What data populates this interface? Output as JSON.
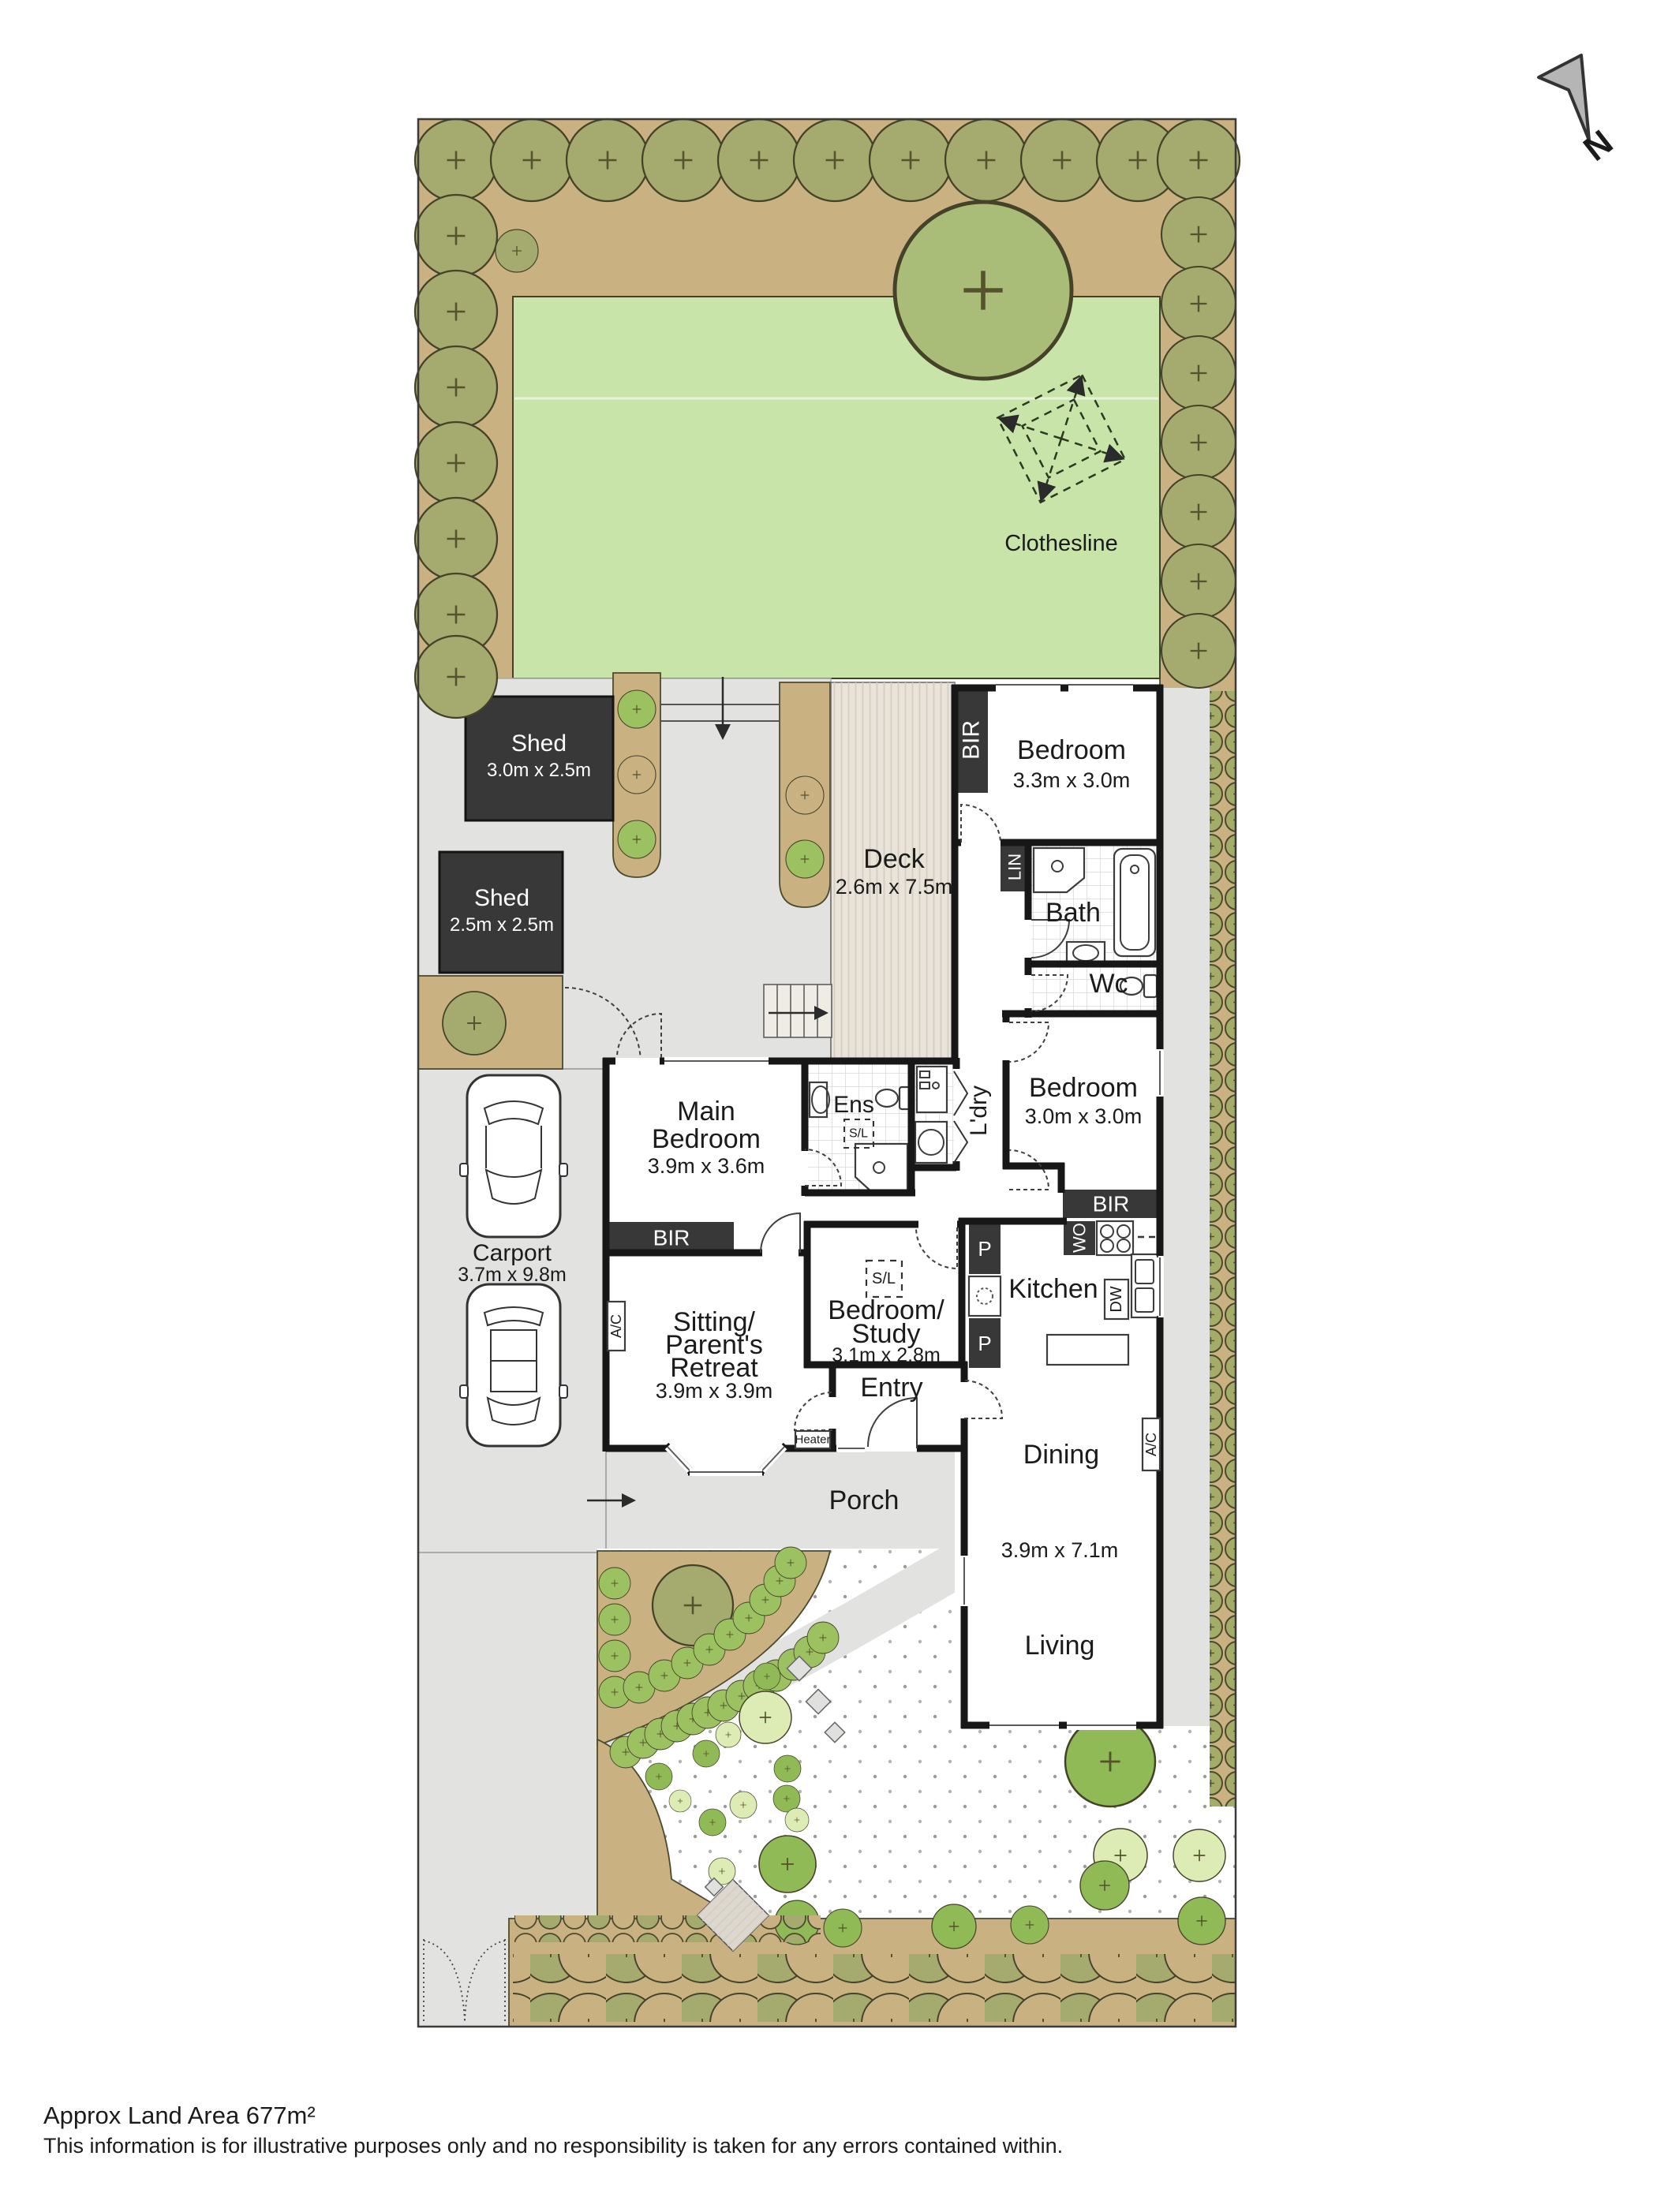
{
  "colors": {
    "wall": "#171717",
    "dark_fixture": "#383838",
    "garden_bed_tan": "#c9b181",
    "lawn_green": "#c8e4a9",
    "tree_olive": "#a5aa6e",
    "shrub_green": "#9cc161",
    "tree_light_green": "#dcecb4",
    "tree_mid_green": "#8fba56",
    "paving_gray": "#e2e2e1",
    "deck_beige": "#e9e3d9"
  },
  "compass": {
    "north": "N"
  },
  "garden": {
    "clothesline": "Clothesline"
  },
  "outbuildings": {
    "sheds": [
      {
        "name": "Shed",
        "dims": "3.0m x 2.5m"
      },
      {
        "name": "Shed",
        "dims": "2.5m x 2.5m"
      }
    ]
  },
  "rooms": {
    "deck": {
      "name": "Deck",
      "dims": "2.6m x 7.5m"
    },
    "bedroom_rear": {
      "name": "Bedroom",
      "dims": "3.3m x 3.0m"
    },
    "bath": {
      "name": "Bath"
    },
    "wc": {
      "name": "Wc"
    },
    "bedroom_mid": {
      "name": "Bedroom",
      "dims": "3.0m x 3.0m"
    },
    "laundry": {
      "name": "L'dry"
    },
    "ensuite": {
      "name": "Ens"
    },
    "main_bedroom": {
      "line1": "Main",
      "line2": "Bedroom",
      "dims": "3.9m x 3.6m"
    },
    "kitchen": {
      "name": "Kitchen"
    },
    "study": {
      "line1": "Bedroom/",
      "line2": "Study",
      "dims": "3.1m x 2.8m"
    },
    "sitting": {
      "line1": "Sitting/",
      "line2": "Parent's",
      "line3": "Retreat",
      "dims": "3.9m x 3.9m"
    },
    "entry": {
      "name": "Entry"
    },
    "dining": {
      "name": "Dining"
    },
    "living": {
      "name": "Living"
    },
    "living_dining_dims": "3.9m x 7.1m",
    "porch": {
      "name": "Porch"
    },
    "carport": {
      "name": "Carport",
      "dims": "3.7m x 9.8m"
    }
  },
  "tags": {
    "bir": "BIR",
    "lin": "LIN",
    "wo": "WO",
    "dw": "DW",
    "pantry": "P",
    "skylight": "S/L",
    "ac": "A/C",
    "heater": "Heater"
  },
  "footer": {
    "land_area": "Approx Land Area 677m²",
    "disclaimer": "This information is for illustrative purposes only and no responsibility is taken for any errors contained within."
  }
}
